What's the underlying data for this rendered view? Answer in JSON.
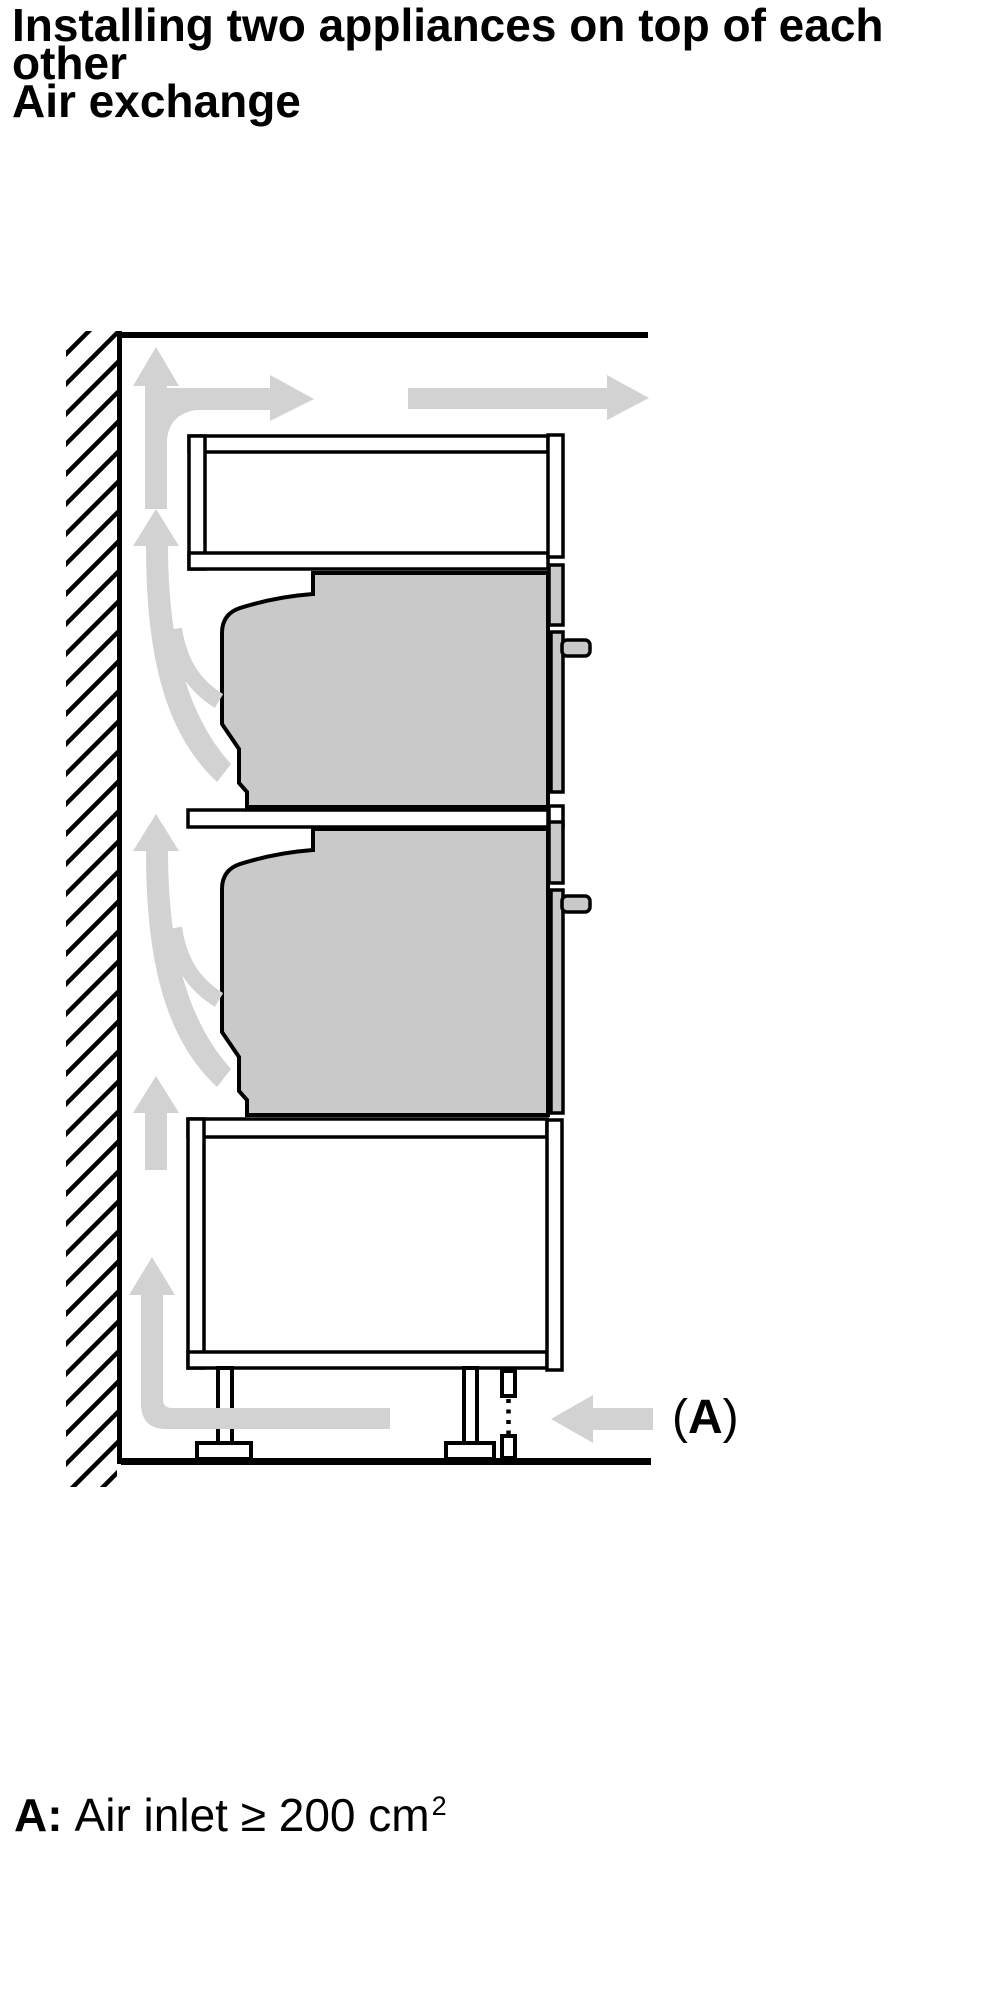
{
  "title": {
    "line1": "Installing two appliances on top of each",
    "line2": "other",
    "line3": "Air exchange"
  },
  "figure_label": {
    "open": "(",
    "letter": "A",
    "close": ")"
  },
  "caption": {
    "prefix": "A:",
    "text": "Air inlet ≥ 200 cm",
    "superscript": "2"
  },
  "colors": {
    "outline": "#000000",
    "appliance_fill": "#c9c9c9",
    "arrow_fill": "#d2d2d2",
    "background": "#ffffff"
  }
}
